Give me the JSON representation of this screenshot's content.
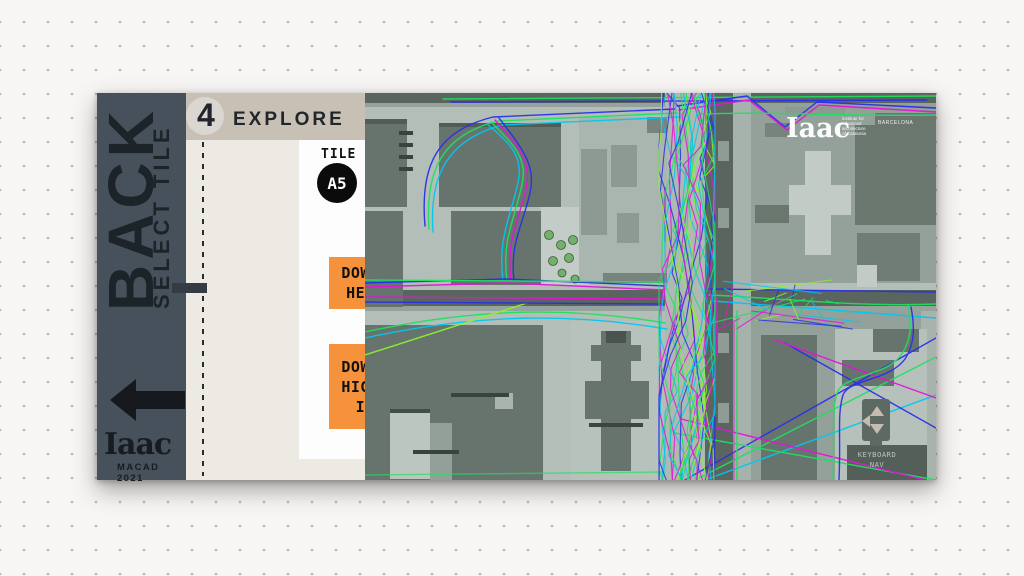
{
  "sidebar": {
    "back_label": "BACK",
    "select_tile_label": "SELECT TILE",
    "logo": "Iaac",
    "logo_subtitle": "MACAD 2021"
  },
  "header": {
    "step_number": "4",
    "title": "EXPLORE"
  },
  "tile": {
    "label": "TILE",
    "value": "A5"
  },
  "pedestrians": {
    "label_line1": "PEDESTRIANS",
    "label_line2": "IN SCENE",
    "value": ""
  },
  "buttons": {
    "download_heatmap": {
      "line1": "DOWNLOAD",
      "line2": "HEATMAP"
    },
    "download_highres": {
      "line1": "DOWNLOAD",
      "line2": "HIGH-RES",
      "line3": "IMAGE"
    }
  },
  "map": {
    "logo": "Iaac",
    "logo_lines": {
      "l1": "institute for",
      "l2": "advanced",
      "l3": "architecture",
      "l4": "of Catalonia"
    },
    "logo_city": "BARCELONA",
    "keyboard_nav": {
      "line1": "KEYBOARD",
      "line2": "NAV"
    },
    "trajectory_colors": [
      "#2a2fe8",
      "#00c8f0",
      "#1fe060",
      "#e414d8",
      "#8ef32c"
    ]
  },
  "colors": {
    "accent_orange": "#f6913c",
    "sidebar": "#47515b",
    "header_beige": "#c8c0b4",
    "panel_beige": "#edeae3",
    "map_base": "#b3beb8"
  }
}
